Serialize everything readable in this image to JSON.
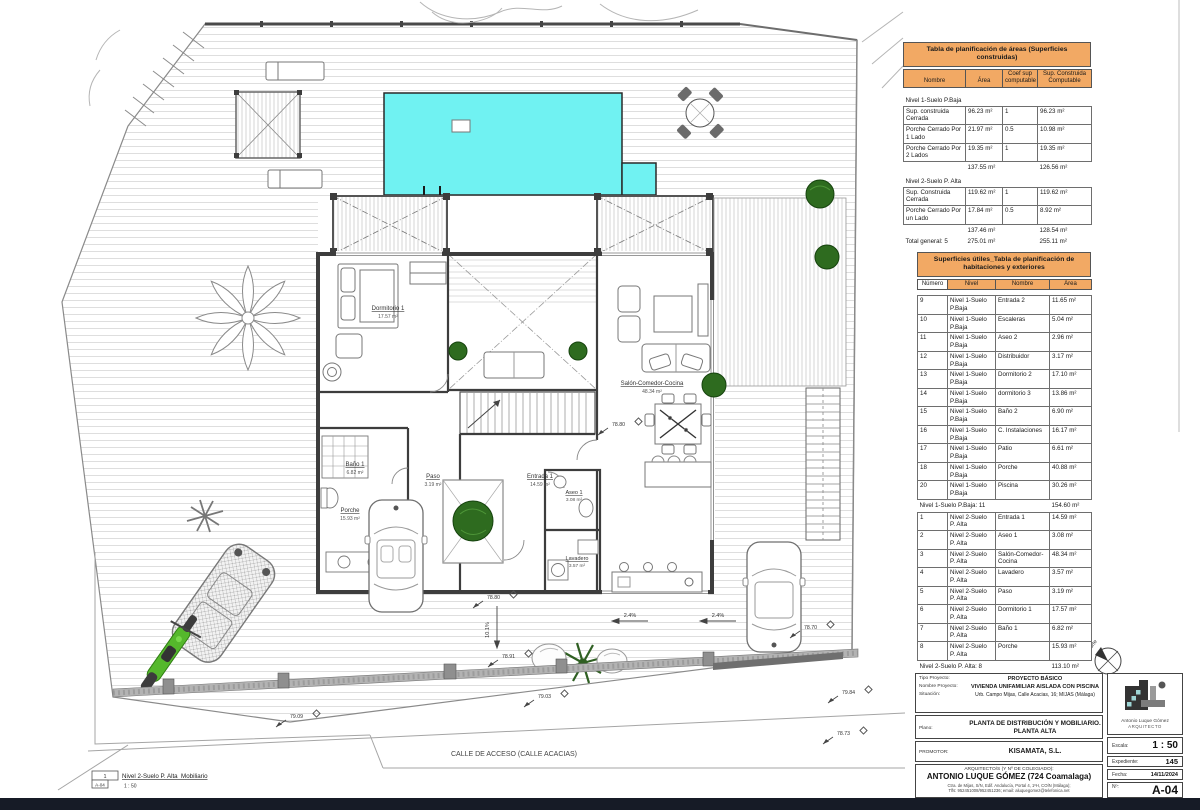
{
  "plan": {
    "street": "CALLE DE ACCESO (CALLE ACACIAS)",
    "rooms": [
      {
        "name": "Dormitorio 1",
        "area": "17.57 m²"
      },
      {
        "name": "Baño 1",
        "area": "6.82 m²"
      },
      {
        "name": "Paso",
        "area": "3.19 m²"
      },
      {
        "name": "Entrada 1",
        "area": "14.59 m²"
      },
      {
        "name": "Salón-Comedor-Cocina",
        "area": "48.34 m²"
      },
      {
        "name": "Aseo 1",
        "area": "3.08 m²"
      },
      {
        "name": "Lavadero",
        "area": "3.57 m²"
      },
      {
        "name": "Porche",
        "area": "15.93 m²"
      }
    ],
    "levels": [
      {
        "v": "78.80"
      },
      {
        "v": "78.80"
      },
      {
        "v": "78.91"
      },
      {
        "v": "78.70"
      },
      {
        "v": "79.84"
      },
      {
        "v": "78.73"
      },
      {
        "v": "79.03"
      },
      {
        "v": "79.09"
      }
    ],
    "slopes": [
      {
        "v": "2.4%"
      },
      {
        "v": "2.4%"
      },
      {
        "v": "10.1%"
      }
    ]
  },
  "legend": {
    "index": "1",
    "sheet": "A-04",
    "title": "Nivel 2-Suelo P. Alta_Mobiliario",
    "scale": "1 : 50"
  },
  "scalebar": {
    "ticks": [
      "0",
      "1",
      "2",
      "3",
      "4"
    ],
    "end": "5 m"
  },
  "north": {
    "label": "Norte"
  },
  "tables": {
    "areas": {
      "title": "Tabla de planificación de áreas (Superficies construidas)",
      "headers": [
        "Nombre",
        "Área",
        "Coef sup computable",
        "Sup. Construida Computable"
      ],
      "rows": [
        {
          "type": "section",
          "name": "Nivel 1-Suelo P.Baja",
          "area": "",
          "coef": "",
          "comp": ""
        },
        {
          "type": "row",
          "name": "Sup. construida Cerrada",
          "area": "96.23 m²",
          "coef": "1",
          "comp": "96.23 m²"
        },
        {
          "type": "row",
          "name": "Porche Cerrado Por 1 Lado",
          "area": "21.97 m²",
          "coef": "0.5",
          "comp": "10.98 m²"
        },
        {
          "type": "row",
          "name": "Porche Cerrado Por 2 Lados",
          "area": "19.35 m²",
          "coef": "1",
          "comp": "19.35 m²"
        },
        {
          "type": "subtotal",
          "name": "",
          "area": "137.55 m²",
          "coef": "",
          "comp": "126.56 m²"
        },
        {
          "type": "section",
          "name": "Nivel 2-Suelo P. Alta",
          "area": "",
          "coef": "",
          "comp": ""
        },
        {
          "type": "row",
          "name": "Sup. Construida Cerrada",
          "area": "119.62 m²",
          "coef": "1",
          "comp": "119.62 m²"
        },
        {
          "type": "row",
          "name": "Porche Cerrado Por un Lado",
          "area": "17.84 m²",
          "coef": "0.5",
          "comp": "8.92 m²"
        },
        {
          "type": "subtotal",
          "name": "",
          "area": "137.46 m²",
          "coef": "",
          "comp": "128.54 m²"
        },
        {
          "type": "total",
          "name": "Total general: 5",
          "area": "275.01 m²",
          "coef": "",
          "comp": "255.11 m²"
        }
      ]
    },
    "rooms": {
      "title": "Superficies útiles_Tabla de planificación de habitaciones y exteriores",
      "headers": [
        "Número",
        "Nivel",
        "Nombre",
        "Área"
      ],
      "rows": [
        {
          "type": "row",
          "num": "9",
          "nivel": "Nivel 1-Suelo P.Baja",
          "nombre": "Entrada 2",
          "area": "11.65 m²"
        },
        {
          "type": "row",
          "num": "10",
          "nivel": "Nivel 1-Suelo P.Baja",
          "nombre": "Escaleras",
          "area": "5.04 m²"
        },
        {
          "type": "row",
          "num": "11",
          "nivel": "Nivel 1-Suelo P.Baja",
          "nombre": "Aseo 2",
          "area": "2.96 m²"
        },
        {
          "type": "row",
          "num": "12",
          "nivel": "Nivel 1-Suelo P.Baja",
          "nombre": "Distribuidor",
          "area": "3.17 m²"
        },
        {
          "type": "row",
          "num": "13",
          "nivel": "Nivel 1-Suelo P.Baja",
          "nombre": "Dormitorio 2",
          "area": "17.10 m²"
        },
        {
          "type": "row",
          "num": "14",
          "nivel": "Nivel 1-Suelo P.Baja",
          "nombre": "dormitorio 3",
          "area": "13.86 m²"
        },
        {
          "type": "row",
          "num": "15",
          "nivel": "Nivel 1-Suelo P.Baja",
          "nombre": "Baño 2",
          "area": "6.90 m²"
        },
        {
          "type": "row",
          "num": "16",
          "nivel": "Nivel 1-Suelo P.Baja",
          "nombre": "C. Instalaciones",
          "area": "16.17 m²"
        },
        {
          "type": "row",
          "num": "17",
          "nivel": "Nivel 1-Suelo P.Baja",
          "nombre": "Patio",
          "area": "6.61 m²"
        },
        {
          "type": "row",
          "num": "18",
          "nivel": "Nivel 1-Suelo P.Baja",
          "nombre": "Porche",
          "area": "40.88 m²"
        },
        {
          "type": "row",
          "num": "20",
          "nivel": "Nivel 1-Suelo P.Baja",
          "nombre": "Piscina",
          "area": "30.26 m²"
        },
        {
          "type": "subtotal",
          "num": "Nivel 1-Suelo P.Baja: 11",
          "nivel": "",
          "nombre": "",
          "area": "154.60 m²"
        },
        {
          "type": "row",
          "num": "1",
          "nivel": "Nivel 2-Suelo P. Alta",
          "nombre": "Entrada 1",
          "area": "14.59 m²"
        },
        {
          "type": "row",
          "num": "2",
          "nivel": "Nivel 2-Suelo P. Alta",
          "nombre": "Aseo 1",
          "area": "3.08 m²"
        },
        {
          "type": "row",
          "num": "3",
          "nivel": "Nivel 2-Suelo P. Alta",
          "nombre": "Salón-Comedor-Cocina",
          "area": "48.34 m²"
        },
        {
          "type": "row",
          "num": "4",
          "nivel": "Nivel 2-Suelo P. Alta",
          "nombre": "Lavadero",
          "area": "3.57 m²"
        },
        {
          "type": "row",
          "num": "5",
          "nivel": "Nivel 2-Suelo P. Alta",
          "nombre": "Paso",
          "area": "3.19 m²"
        },
        {
          "type": "row",
          "num": "6",
          "nivel": "Nivel 2-Suelo P. Alta",
          "nombre": "Dormitorio 1",
          "area": "17.57 m²"
        },
        {
          "type": "row",
          "num": "7",
          "nivel": "Nivel 2-Suelo P. Alta",
          "nombre": "Baño 1",
          "area": "6.82 m²"
        },
        {
          "type": "row",
          "num": "8",
          "nivel": "Nivel 2-Suelo P. Alta",
          "nombre": "Porche",
          "area": "15.93 m²"
        },
        {
          "type": "subtotal",
          "num": "Nivel 2-Suelo P. Alta: 8",
          "nivel": "",
          "nombre": "",
          "area": "113.10 m²"
        },
        {
          "type": "total",
          "num": "Total general: 19",
          "nivel": "",
          "nombre": "",
          "area": "267.69 m²"
        }
      ]
    }
  },
  "titleblock": {
    "tipo_label": "Tipo Proyecto:",
    "tipo": "PROYECTO BÁSICO",
    "nombre_label": "Nombre Proyecto:",
    "nombre": "VIVIENDA UNIFAMILIAR AISLADA CON PISCINA",
    "situacion_label": "Situación:",
    "situacion": "Urb. Campo Mijas, Calle Acacias, 16; MIJAS (Málaga)",
    "plano_label": "Plano:",
    "plano": "PLANTA DE DISTRIBUCIÓN Y MOBILIARIO. PLANTA ALTA",
    "promotor_label": "PROMOTOR:",
    "promotor": "KISAMATA, S.L.",
    "arquitecto_label": "ARQUITECTO/S (Y Nº DE COLEGIADO):",
    "arquitecto": "ANTONIO LUQUE GÓMEZ (724 Coamalaga)",
    "address": "Ctra. de Mijas, S/N, Edif. Andalucía, Portal 4, 1ºH, COÍN (Málaga);",
    "phone": "Tlfs: 952451008/952451236; email: aluquegomez@telefonica.net",
    "logo_name": "Antonio Luque Gómez",
    "logo_title": "ARQUITECTO",
    "escala_label": "Escala:",
    "escala": "1 : 50",
    "expediente_label": "Expediente:",
    "expediente": "145",
    "fecha_label": "Fecha:",
    "fecha": "14/11/2024",
    "num_label": "Nº:",
    "num": "A-04"
  },
  "colors": {
    "pool": "#70f2f2",
    "table_header": "#f2a964",
    "tree": "#2e6b1f",
    "moto": "#55b82c",
    "bottom_bar": "#161b26"
  }
}
